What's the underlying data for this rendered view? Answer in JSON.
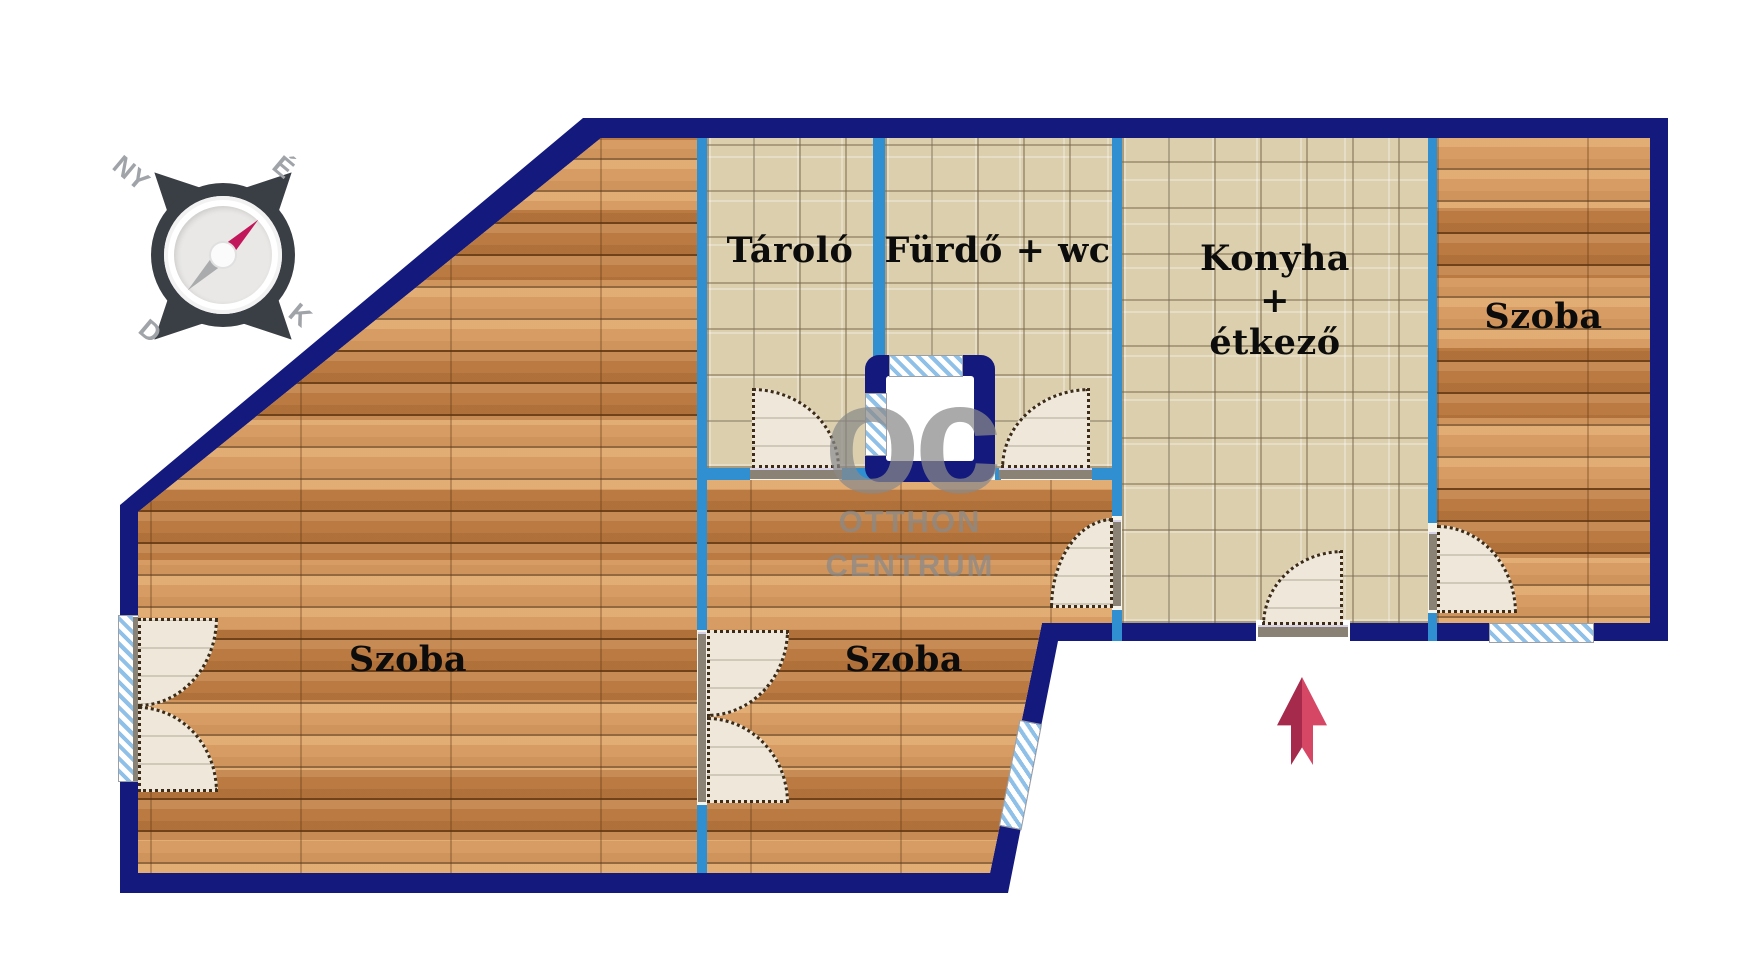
{
  "rooms": {
    "taro": "Tároló",
    "furdo": "Fürdő + wc",
    "konyha": [
      "Konyha",
      "+",
      "étkező"
    ],
    "szoba_left": "Szoba",
    "szoba_middle": "Szoba",
    "szoba_right": "Szoba"
  },
  "compass": {
    "nw": "NY",
    "ne": "É",
    "sw": "D",
    "se": "K"
  },
  "watermark": {
    "logo": "oc",
    "line1": "OTTHON",
    "line2": "CENTRUM"
  },
  "colors": {
    "outer_wall": "#14197d",
    "inner_wall": "#2f8fd0",
    "wood": "#cb8a4e",
    "tile": "#dccfae",
    "arrow_dark": "#a52a4b",
    "arrow_light": "#d64765",
    "needle_red": "#c2185b"
  }
}
